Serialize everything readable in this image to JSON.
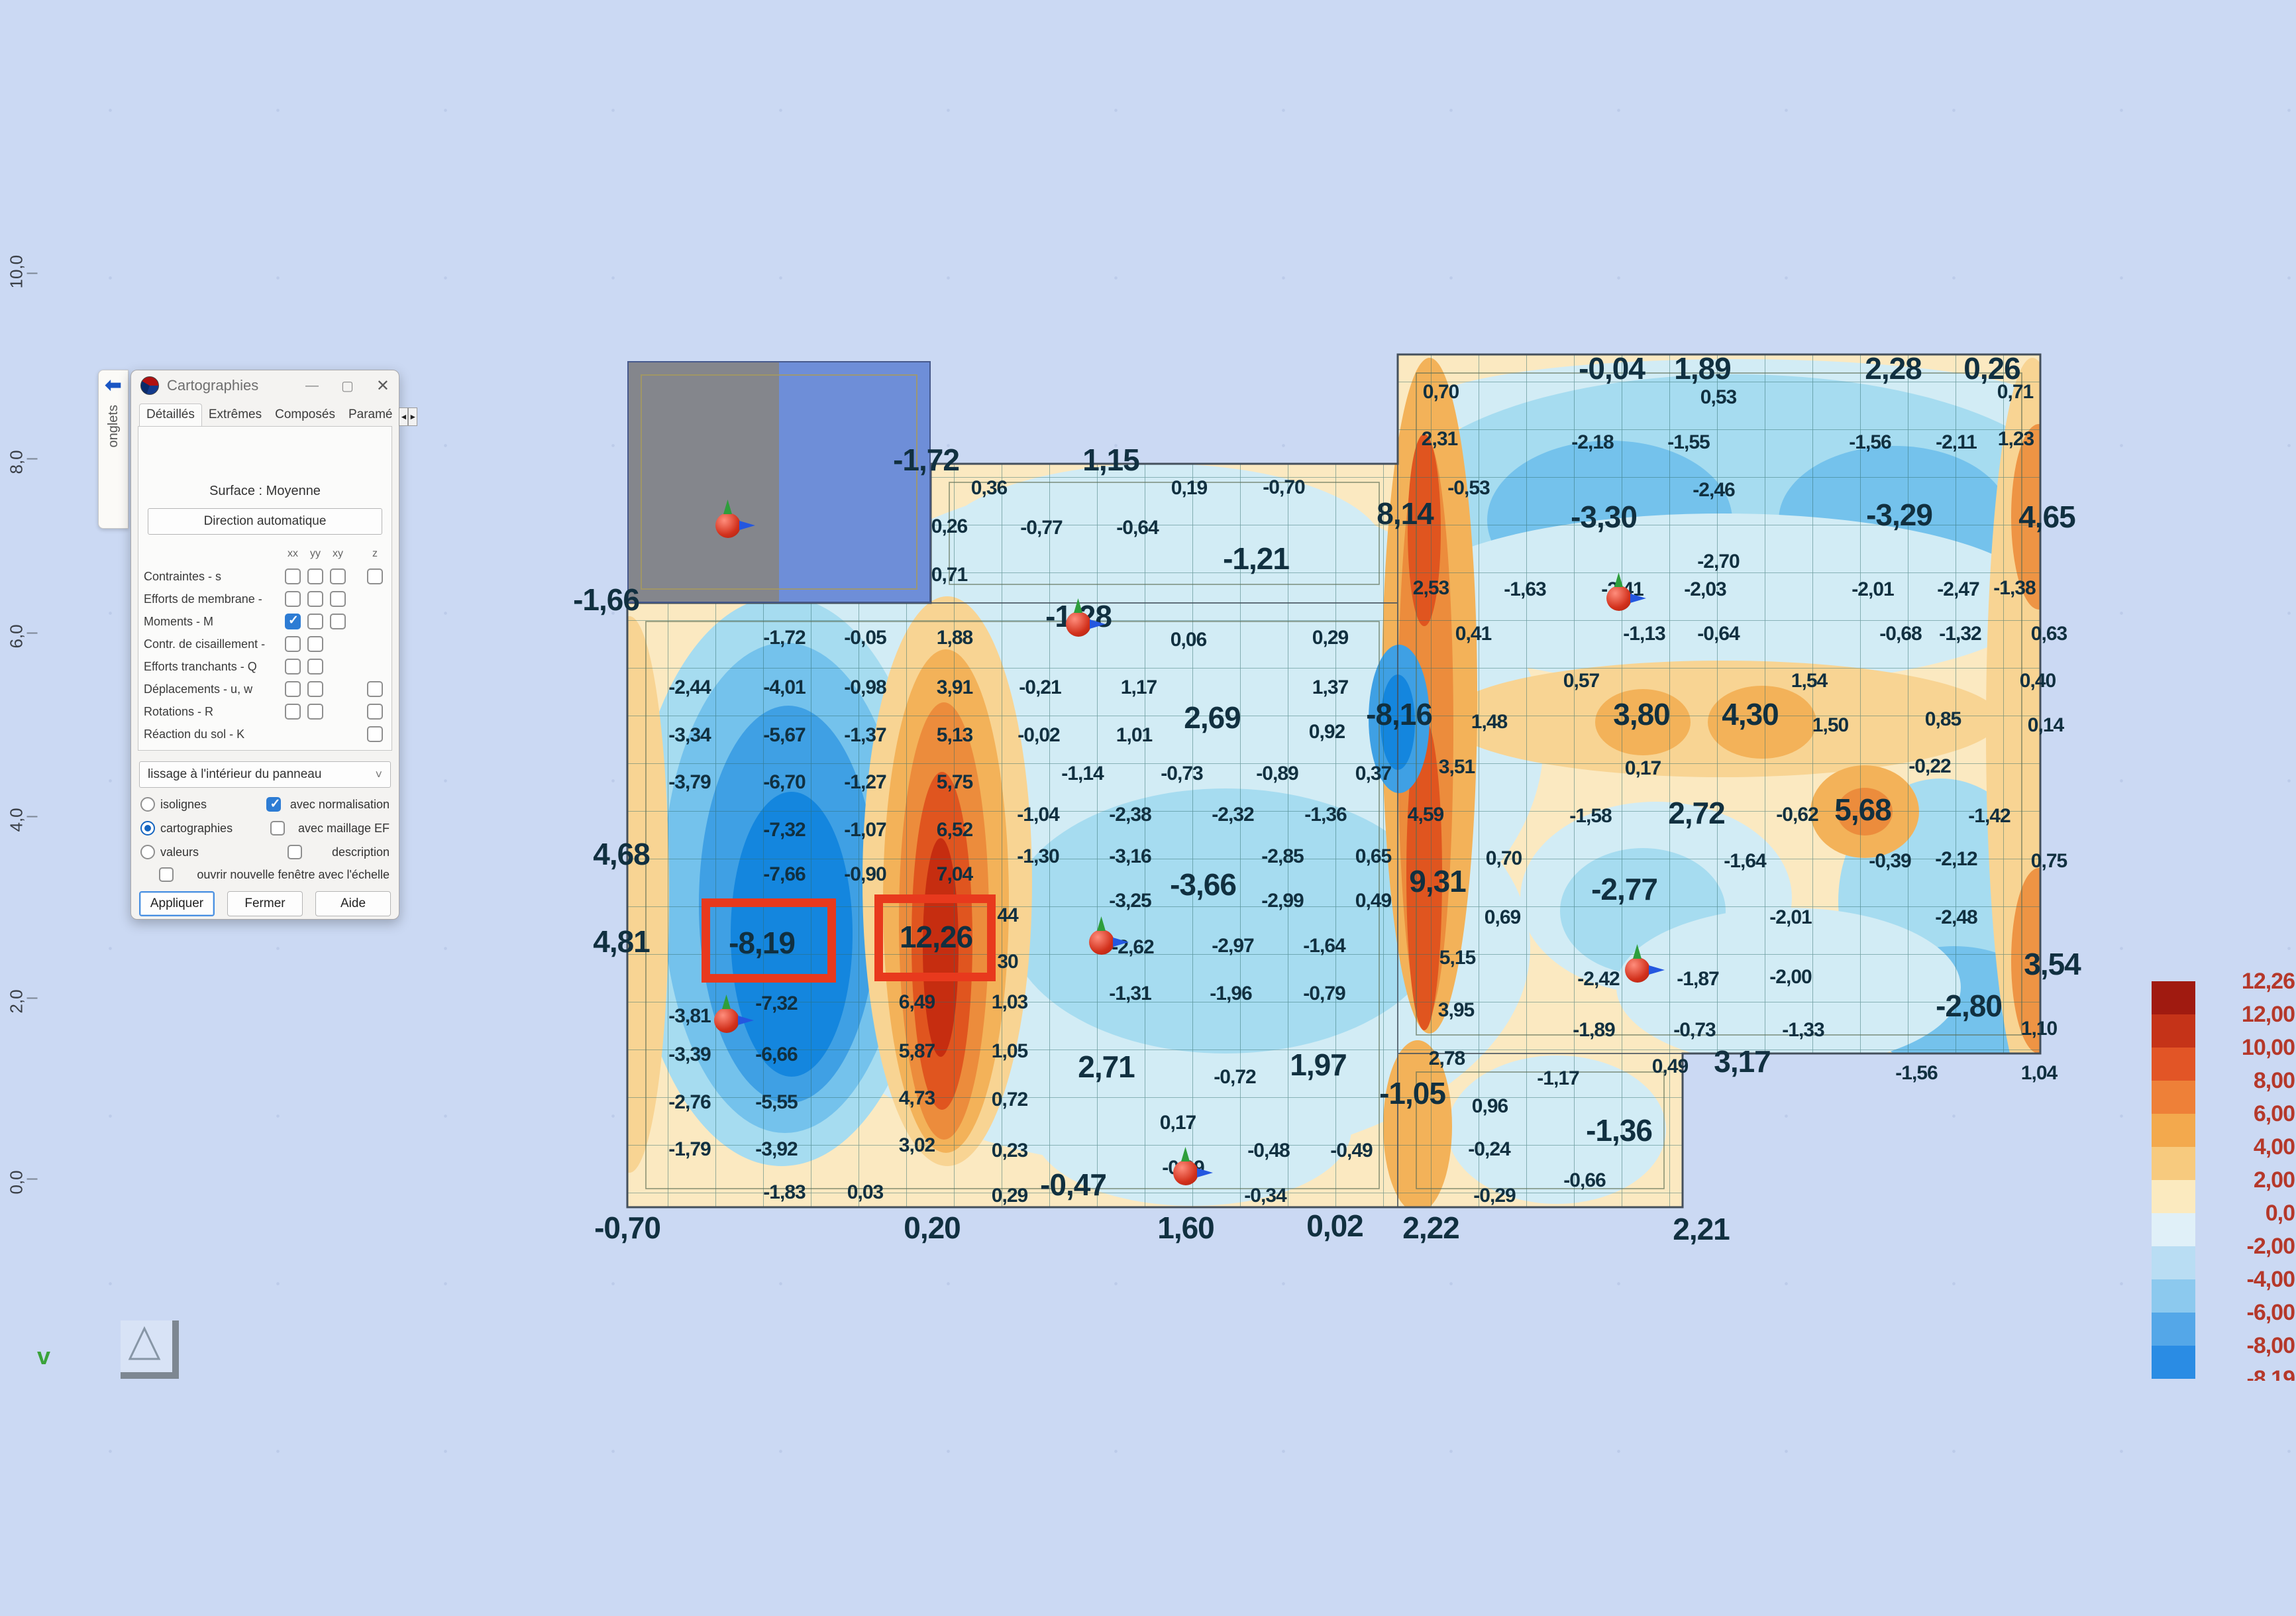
{
  "app": {
    "title": "Cartographies",
    "window_buttons": {
      "minimize": "—",
      "maximize": "▢",
      "close": "✕"
    }
  },
  "dock_tab": {
    "label": "onglets",
    "arrow": "⬅"
  },
  "dialog": {
    "tabs": [
      {
        "label": "Détaillés",
        "active": true
      },
      {
        "label": "Extrêmes",
        "active": false
      },
      {
        "label": "Composés",
        "active": false
      },
      {
        "label": "Paramé",
        "active": false
      }
    ],
    "tab_scroll": [
      "◄",
      "►"
    ],
    "surface_label": "Surface : Moyenne",
    "direction_button": "Direction automatique",
    "matrix": {
      "header": [
        "xx",
        "yy",
        "xy",
        "z"
      ],
      "rows": [
        {
          "label": "Contraintes - s",
          "slots": [
            1,
            1,
            1
          ],
          "z": true,
          "checked": []
        },
        {
          "label": "Efforts de membrane -",
          "slots": [
            1,
            1,
            1
          ],
          "z": false,
          "checked": []
        },
        {
          "label": "Moments - M",
          "slots": [
            1,
            1,
            1
          ],
          "z": false,
          "checked": [
            0
          ]
        },
        {
          "label": "Contr. de cisaillement -",
          "slots": [
            1,
            1,
            0
          ],
          "z": false,
          "checked": []
        },
        {
          "label": "Efforts tranchants - Q",
          "slots": [
            1,
            1,
            0
          ],
          "z": false,
          "checked": []
        },
        {
          "label": "Déplacements - u, w",
          "slots": [
            1,
            1,
            0
          ],
          "z": true,
          "checked": []
        },
        {
          "label": "Rotations - R",
          "slots": [
            1,
            1,
            0
          ],
          "z": true,
          "checked": []
        },
        {
          "label": "Réaction du sol - K",
          "slots": [
            0,
            0,
            0
          ],
          "z": true,
          "checked": []
        }
      ]
    },
    "smoothing_select": {
      "value": "lissage à l'intérieur du panneau",
      "chevron": "˅"
    },
    "display_radios": [
      {
        "label": "isolignes",
        "checked": false
      },
      {
        "label": "cartographies",
        "checked": true
      },
      {
        "label": "valeurs",
        "checked": false
      }
    ],
    "option_checks": [
      {
        "label": "avec normalisation",
        "checked": true
      },
      {
        "label": "avec maillage EF",
        "checked": false
      },
      {
        "label": "description",
        "checked": false
      }
    ],
    "new_window_check": {
      "label": "ouvrir nouvelle fenêtre avec l'échelle",
      "checked": false
    },
    "buttons": [
      "Appliquer",
      "Fermer",
      "Aide"
    ]
  },
  "ruler": {
    "labels": [
      [
        "10,0",
        420
      ],
      [
        "8,0",
        700
      ],
      [
        "6,0",
        963
      ],
      [
        "4,0",
        1240
      ],
      [
        "2,0",
        1514
      ],
      [
        "0,0",
        1787
      ]
    ]
  },
  "viewport": {
    "axis_hint": "v"
  },
  "map": {
    "labels": [
      [
        "-1,66",
        915,
        905,
        1
      ],
      [
        "-1,72",
        1398,
        694,
        1
      ],
      [
        "1,15",
        1677,
        694,
        1
      ],
      [
        "0,36",
        1493,
        737
      ],
      [
        "0,19",
        1795,
        737
      ],
      [
        "-0,70",
        1938,
        736
      ],
      [
        "0,26",
        1433,
        795
      ],
      [
        "-0,77",
        1572,
        797
      ],
      [
        "-0,64",
        1717,
        797
      ],
      [
        "-1,21",
        1896,
        843,
        1
      ],
      [
        "0,71",
        1433,
        868
      ],
      [
        "-1,72",
        1184,
        963
      ],
      [
        "-0,05",
        1306,
        963
      ],
      [
        "1,88",
        1441,
        963
      ],
      [
        "-1,28",
        1628,
        930,
        1
      ],
      [
        "0,06",
        1794,
        966
      ],
      [
        "0,29",
        2008,
        963
      ],
      [
        "-2,44",
        1041,
        1038
      ],
      [
        "-4,01",
        1184,
        1038
      ],
      [
        "-0,98",
        1306,
        1038
      ],
      [
        "3,91",
        1441,
        1038
      ],
      [
        "-0,21",
        1570,
        1038
      ],
      [
        "1,17",
        1719,
        1038
      ],
      [
        "1,37",
        2008,
        1038
      ],
      [
        "-3,34",
        1041,
        1110
      ],
      [
        "-5,67",
        1184,
        1110
      ],
      [
        "-1,37",
        1306,
        1110
      ],
      [
        "5,13",
        1441,
        1110
      ],
      [
        "-0,02",
        1568,
        1110
      ],
      [
        "1,01",
        1712,
        1110
      ],
      [
        "2,69",
        1830,
        1083,
        1
      ],
      [
        "0,92",
        2003,
        1105
      ],
      [
        "-8,16",
        2112,
        1078,
        1
      ],
      [
        "1,48",
        2248,
        1090
      ],
      [
        "-3,79",
        1041,
        1181
      ],
      [
        "-6,70",
        1184,
        1181
      ],
      [
        "-1,27",
        1306,
        1181
      ],
      [
        "5,75",
        1441,
        1181
      ],
      [
        "-1,14",
        1634,
        1168
      ],
      [
        "-0,73",
        1784,
        1168
      ],
      [
        "-0,89",
        1928,
        1168
      ],
      [
        "0,37",
        2073,
        1168
      ],
      [
        "3,51",
        2199,
        1158
      ],
      [
        "-7,32",
        1184,
        1253
      ],
      [
        "-1,07",
        1306,
        1253
      ],
      [
        "6,52",
        1441,
        1253
      ],
      [
        "-1,04",
        1567,
        1230
      ],
      [
        "-2,38",
        1706,
        1230
      ],
      [
        "-2,32",
        1861,
        1230
      ],
      [
        "-1,36",
        2001,
        1230
      ],
      [
        "4,59",
        2152,
        1230
      ],
      [
        "4,68",
        938,
        1289,
        1
      ],
      [
        "-7,66",
        1184,
        1320
      ],
      [
        "-0,90",
        1306,
        1320
      ],
      [
        "7,04",
        1441,
        1320
      ],
      [
        "-1,30",
        1567,
        1293
      ],
      [
        "-3,16",
        1706,
        1293
      ],
      [
        "-2,85",
        1936,
        1293
      ],
      [
        "0,65",
        2073,
        1293
      ],
      [
        "0,70",
        2270,
        1296
      ],
      [
        "-3,66",
        1816,
        1335,
        1
      ],
      [
        "9,31",
        2170,
        1330,
        1
      ],
      [
        "0,69",
        2268,
        1385
      ],
      [
        "4,81",
        938,
        1421,
        1
      ],
      [
        "-8,19",
        1150,
        1423,
        1
      ],
      [
        "12,26",
        1413,
        1414,
        1
      ],
      [
        "44",
        1521,
        1382
      ],
      [
        "-3,25",
        1706,
        1360
      ],
      [
        "-2,99",
        1936,
        1360
      ],
      [
        "0,49",
        2073,
        1360
      ],
      [
        "30",
        1521,
        1452
      ],
      [
        "-2,62",
        1710,
        1430
      ],
      [
        "-2,97",
        1861,
        1428
      ],
      [
        "-1,64",
        1999,
        1428
      ],
      [
        "5,15",
        2200,
        1446
      ],
      [
        "-3,81",
        1041,
        1534
      ],
      [
        "-7,32",
        1172,
        1515
      ],
      [
        "6,49",
        1384,
        1513
      ],
      [
        "1,03",
        1524,
        1513
      ],
      [
        "-1,31",
        1706,
        1500
      ],
      [
        "-1,96",
        1858,
        1500
      ],
      [
        "-0,79",
        1999,
        1500
      ],
      [
        "3,95",
        2198,
        1525
      ],
      [
        "-3,39",
        1041,
        1592
      ],
      [
        "-6,66",
        1172,
        1592
      ],
      [
        "5,87",
        1384,
        1587
      ],
      [
        "1,05",
        1524,
        1587
      ],
      [
        "2,71",
        1670,
        1610,
        1
      ],
      [
        "-0,72",
        1864,
        1626
      ],
      [
        "1,97",
        1990,
        1607,
        1
      ],
      [
        "-1,05",
        2132,
        1650,
        1
      ],
      [
        "0,96",
        2249,
        1670
      ],
      [
        "2,78",
        2184,
        1598
      ],
      [
        "-2,76",
        1041,
        1664
      ],
      [
        "-5,55",
        1172,
        1664
      ],
      [
        "4,73",
        1384,
        1658
      ],
      [
        "0,72",
        1524,
        1660
      ],
      [
        "0,17",
        1778,
        1695
      ],
      [
        "-1,79",
        1041,
        1735
      ],
      [
        "-3,92",
        1172,
        1735
      ],
      [
        "3,02",
        1384,
        1729
      ],
      [
        "0,23",
        1524,
        1737
      ],
      [
        "-0,47",
        1620,
        1788,
        1
      ],
      [
        "-0,09",
        1786,
        1763
      ],
      [
        "-0,48",
        1915,
        1737
      ],
      [
        "-0,49",
        2040,
        1737
      ],
      [
        "-0,24",
        2248,
        1735
      ],
      [
        "-1,36",
        2444,
        1706,
        1
      ],
      [
        "-1,83",
        1184,
        1800
      ],
      [
        "0,03",
        1306,
        1800
      ],
      [
        "0,29",
        1524,
        1805
      ],
      [
        "-0,34",
        1910,
        1805
      ],
      [
        "-0,29",
        2256,
        1805
      ],
      [
        "-0,66",
        2392,
        1782
      ],
      [
        "-0,70",
        947,
        1853,
        1
      ],
      [
        "0,20",
        1407,
        1853,
        1
      ],
      [
        "1,60",
        1790,
        1853,
        1
      ],
      [
        "0,02",
        2015,
        1850,
        1
      ],
      [
        "2,22",
        2160,
        1853,
        1
      ],
      [
        "2,21",
        2568,
        1855,
        1
      ],
      [
        "3,17",
        2630,
        1602,
        1
      ],
      [
        "-0,04",
        2433,
        556,
        1
      ],
      [
        "1,89",
        2570,
        556,
        1
      ],
      [
        "2,28",
        2858,
        556,
        1
      ],
      [
        "0,26",
        3007,
        556,
        1
      ],
      [
        "0,70",
        2175,
        592
      ],
      [
        "0,53",
        2594,
        600
      ],
      [
        "0,71",
        3042,
        592
      ],
      [
        "2,31",
        2173,
        663
      ],
      [
        "-2,18",
        2404,
        668
      ],
      [
        "-1,55",
        2549,
        668
      ],
      [
        "-1,56",
        2823,
        668
      ],
      [
        "-2,11",
        2953,
        668
      ],
      [
        "1,23",
        3043,
        663
      ],
      [
        "-0,53",
        2217,
        737
      ],
      [
        "-2,46",
        2587,
        740
      ],
      [
        "8,14",
        2121,
        775,
        1
      ],
      [
        "-3,30",
        2421,
        780,
        1
      ],
      [
        "-3,29",
        2867,
        777,
        1
      ],
      [
        "4,65",
        3090,
        780,
        1
      ],
      [
        "-2,70",
        2594,
        848
      ],
      [
        "2,53",
        2160,
        888
      ],
      [
        "-1,63",
        2302,
        890
      ],
      [
        "-2,41",
        2449,
        890
      ],
      [
        "-2,03",
        2574,
        890
      ],
      [
        "-2,01",
        2827,
        890
      ],
      [
        "-2,47",
        2956,
        890
      ],
      [
        "-1,38",
        3041,
        888
      ],
      [
        "0,41",
        2224,
        957
      ],
      [
        "-1,13",
        2482,
        957
      ],
      [
        "-0,64",
        2594,
        957
      ],
      [
        "-0,68",
        2869,
        957
      ],
      [
        "-1,32",
        2959,
        957
      ],
      [
        "0,63",
        3093,
        957
      ],
      [
        "0,57",
        2387,
        1028
      ],
      [
        "1,54",
        2731,
        1028
      ],
      [
        "0,40",
        3076,
        1028
      ],
      [
        "3,80",
        2478,
        1078,
        1
      ],
      [
        "4,30",
        2642,
        1078,
        1
      ],
      [
        "1,50",
        2763,
        1095
      ],
      [
        "0,85",
        2933,
        1086
      ],
      [
        "0,14",
        3088,
        1095
      ],
      [
        "0,17",
        2480,
        1160
      ],
      [
        "-0,22",
        2913,
        1157
      ],
      [
        "-1,58",
        2401,
        1232
      ],
      [
        "2,72",
        2561,
        1227,
        1
      ],
      [
        "-0,62",
        2713,
        1230
      ],
      [
        "5,68",
        2812,
        1222,
        1
      ],
      [
        "-1,42",
        3003,
        1232
      ],
      [
        "-1,64",
        2634,
        1300
      ],
      [
        "-0,39",
        2853,
        1300
      ],
      [
        "-2,12",
        2953,
        1297
      ],
      [
        "0,75",
        3093,
        1300
      ],
      [
        "-2,77",
        2452,
        1342,
        1
      ],
      [
        "-2,01",
        2703,
        1385
      ],
      [
        "-2,48",
        2953,
        1385
      ],
      [
        "-2,42",
        2413,
        1478
      ],
      [
        "-1,87",
        2563,
        1478
      ],
      [
        "-2,00",
        2703,
        1475
      ],
      [
        "3,54",
        3098,
        1455,
        1
      ],
      [
        "-2,80",
        2972,
        1518,
        1
      ],
      [
        "-1,89",
        2406,
        1555
      ],
      [
        "-0,73",
        2558,
        1555
      ],
      [
        "-1,33",
        2722,
        1555
      ],
      [
        "1,10",
        3078,
        1553
      ],
      [
        "-1,17",
        2352,
        1628
      ],
      [
        "0,49",
        2521,
        1610
      ],
      [
        "-1,56",
        2893,
        1620
      ],
      [
        "1,04",
        3078,
        1620
      ]
    ],
    "nodes": [
      [
        1099,
        793
      ],
      [
        1628,
        942
      ],
      [
        1097,
        1540
      ],
      [
        1663,
        1422
      ],
      [
        1790,
        1770
      ],
      [
        2444,
        903
      ],
      [
        2472,
        1464
      ]
    ],
    "highlight_boxes": [
      [
        1059,
        1356,
        203,
        127
      ],
      [
        1320,
        1350,
        183,
        131
      ]
    ]
  },
  "legend": {
    "colors": [
      "#a01a10",
      "#c53318",
      "#e25526",
      "#ee8038",
      "#f3a94d",
      "#f7ca7e",
      "#fbeabf",
      "#e0f0f8",
      "#b9ddf3",
      "#8cc9ee",
      "#54a7e8",
      "#2a8ce4"
    ],
    "labels": [
      "12,26",
      "12,00",
      "10,00",
      "8,00",
      "6,00",
      "4,00",
      "2,00",
      "0,0",
      "-2,00",
      "-4,00",
      "-6,00",
      "-8,00",
      "-8,19"
    ]
  },
  "colors": {
    "accent_red": "#e8391d",
    "background": "#cbd9f3",
    "value_text": "#113040",
    "legend_text": "#b5382a"
  }
}
